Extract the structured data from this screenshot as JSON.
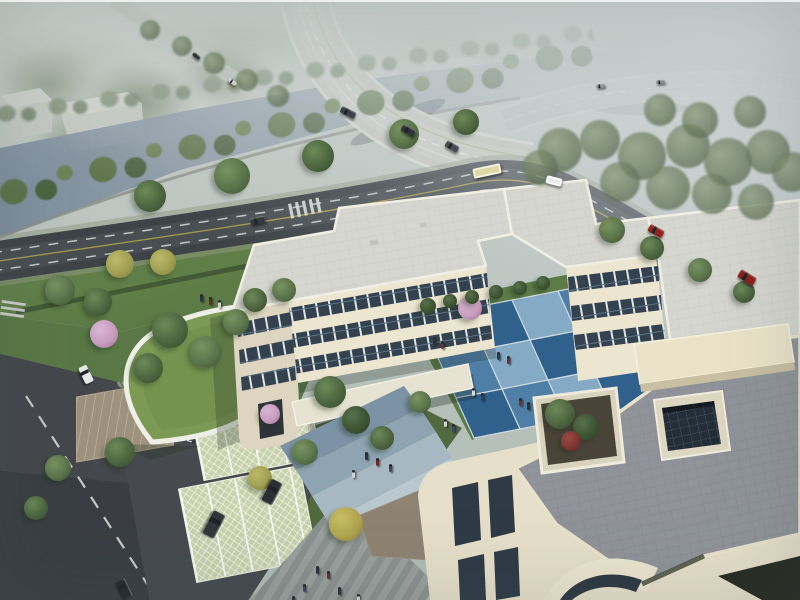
{
  "meta": {
    "title": "Aerial architectural rendering of a courtyard office campus beside a canal and elevated expressway",
    "alt": "Bird's-eye architectural rendering: a cream three-story courtyard building with flat grey roofs and a blue checkerboard courtyard plaza, a leaf-shaped green-roof entrance pavilion, grass-grid parking with dark SUVs, dark asphalt roads with cars and a bus, a blue-grey canal lined with trees, and a curving elevated bridge fading into haze at the top."
  },
  "palette": {
    "sky_haze": "#c5cbc5",
    "water": "#8494a4",
    "asphalt": "#3e4347",
    "bridge_deck": "#c7c7c0",
    "building_wall": "#ece5cf",
    "building_wall_shade": "#ddd5bf",
    "building_roof": "#d6d6d0",
    "terrace_paving": "#90949a",
    "window_dark": "#33424e",
    "lawn": "#5a7845",
    "courtyard_blue_light": "#85aac6",
    "courtyard_blue_mid": "#4f7fa6",
    "courtyard_blue_deep": "#2f618c",
    "blossom_pink": "#c79cbe",
    "parking_grass_grid": "#c8d2ad",
    "lane_dash": "#d9dcd8",
    "lane_yellow": "#b3a44c",
    "tree_colors": {
      "g1": [
        "#6d8a58",
        "#4d6540",
        "#33482c"
      ],
      "g2": [
        "#7a9362",
        "#5a744b",
        "#3d5334"
      ],
      "g3": [
        "#8a9a78",
        "#66785a",
        "#4c5c44"
      ],
      "g3d": [
        "#58704a",
        "#3d5434",
        "#2a3d24"
      ],
      "y1": [
        "#bdb96a",
        "#a19f52",
        "#7d7c3c"
      ],
      "y2": [
        "#cabf66",
        "#b0a650",
        "#8a8038"
      ],
      "p": [
        "#dbb6d4",
        "#c79cbe",
        "#9f729a"
      ],
      "rd": [
        "#9a4a42",
        "#7c3632",
        "#572422"
      ]
    }
  },
  "scene": {
    "objects": [
      "elevated-bridge",
      "canal",
      "main-road",
      "side-street",
      "courtyard-building",
      "blue-checkerboard-courtyard",
      "green-roof-pavilion",
      "roof-terrace",
      "planter",
      "light-well",
      "grass-grid-parking",
      "pedestrian-plaza",
      "entrance-gate"
    ],
    "courtyard": {
      "origin": [
        420,
        318
      ],
      "u": [
        46,
        -9
      ],
      "v": [
        18,
        40
      ],
      "joint": "#cfd9df",
      "colors": {
        "light": "#85aac6",
        "mid": "#4f7fa6",
        "deep": "#2f618c"
      },
      "tiles": [
        [
          "light",
          "deep",
          "light",
          "mid"
        ],
        [
          "mid",
          "light",
          "deep",
          "light"
        ],
        [
          "deep",
          "mid",
          "light",
          "deep"
        ]
      ]
    },
    "trees": [
      [
        60,
        290,
        15,
        "g2"
      ],
      [
        98,
        302,
        14,
        "g1"
      ],
      [
        120,
        264,
        14,
        "y1"
      ],
      [
        163,
        262,
        13,
        "y1"
      ],
      [
        170,
        330,
        18,
        "g1"
      ],
      [
        206,
        352,
        16,
        "g2"
      ],
      [
        148,
        368,
        15,
        "g1"
      ],
      [
        236,
        322,
        13,
        "g2"
      ],
      [
        255,
        300,
        12,
        "g1"
      ],
      [
        284,
        290,
        12,
        "g2"
      ],
      [
        104,
        334,
        14,
        "p"
      ],
      [
        470,
        308,
        12,
        "p"
      ],
      [
        270,
        414,
        10,
        "p"
      ],
      [
        330,
        392,
        16,
        "g1"
      ],
      [
        356,
        420,
        14,
        "g3d"
      ],
      [
        305,
        452,
        13,
        "g2"
      ],
      [
        382,
        438,
        12,
        "g1"
      ],
      [
        420,
        402,
        11,
        "g2"
      ],
      [
        120,
        452,
        15,
        "g1"
      ],
      [
        58,
        468,
        13,
        "g2"
      ],
      [
        36,
        508,
        12,
        "g1"
      ],
      [
        346,
        524,
        17,
        "y2"
      ],
      [
        260,
        478,
        12,
        "y1"
      ],
      [
        612,
        230,
        13,
        "g2"
      ],
      [
        652,
        248,
        12,
        "g1"
      ],
      [
        700,
        270,
        12,
        "g2"
      ],
      [
        744,
        292,
        11,
        "g1"
      ],
      [
        560,
        414,
        15,
        "g1"
      ],
      [
        586,
        427,
        13,
        "g3d"
      ],
      [
        571,
        441,
        10,
        "rd"
      ],
      [
        428,
        306,
        8,
        "g3d"
      ],
      [
        450,
        301,
        7,
        "g3d"
      ],
      [
        472,
        297,
        7,
        "g3d"
      ],
      [
        496,
        292,
        7,
        "g3d"
      ],
      [
        520,
        288,
        7,
        "g3d"
      ],
      [
        543,
        283,
        7,
        "g3d"
      ],
      [
        150,
        196,
        16,
        "g1"
      ],
      [
        232,
        176,
        18,
        "g2"
      ],
      [
        318,
        156,
        16,
        "g1"
      ],
      [
        404,
        134,
        15,
        "g2"
      ],
      [
        466,
        122,
        13,
        "g1"
      ],
      [
        560,
        150,
        22,
        "g3",
        1
      ],
      [
        600,
        140,
        20,
        "g3",
        1
      ],
      [
        642,
        156,
        24,
        "g3",
        1
      ],
      [
        688,
        146,
        22,
        "g3",
        1
      ],
      [
        728,
        162,
        24,
        "g3",
        1
      ],
      [
        768,
        152,
        22,
        "g3",
        1
      ],
      [
        792,
        172,
        20,
        "g3",
        1
      ],
      [
        620,
        182,
        20,
        "g3",
        1
      ],
      [
        668,
        188,
        22,
        "g3",
        1
      ],
      [
        712,
        194,
        20,
        "g3",
        1
      ],
      [
        756,
        202,
        18,
        "g3",
        1
      ],
      [
        540,
        168,
        18,
        "g3",
        1
      ],
      [
        150,
        30,
        10,
        "g3",
        1
      ],
      [
        182,
        46,
        10,
        "g3",
        1
      ],
      [
        214,
        63,
        11,
        "g3",
        1
      ],
      [
        247,
        80,
        11,
        "g3",
        1
      ],
      [
        278,
        96,
        11,
        "g3",
        1
      ],
      [
        700,
        120,
        18,
        "g3",
        1
      ],
      [
        750,
        112,
        16,
        "g3",
        1
      ],
      [
        660,
        110,
        16,
        "g3",
        1
      ]
    ],
    "vehicles": [
      {
        "t": "sedan",
        "x": 348,
        "y": 112,
        "w": 16,
        "h": 7,
        "r": 27,
        "c": "#3a4046"
      },
      {
        "t": "sedan",
        "x": 408,
        "y": 130,
        "w": 15,
        "h": 7,
        "r": 29,
        "c": "#2e3338"
      },
      {
        "t": "sedan",
        "x": 452,
        "y": 146,
        "w": 14,
        "h": 7,
        "r": 30,
        "c": "#454a50"
      },
      {
        "t": "car",
        "x": 600,
        "y": 86,
        "w": 9,
        "h": 4,
        "r": -8,
        "c": "#8a9096"
      },
      {
        "t": "car",
        "x": 660,
        "y": 82,
        "w": 9,
        "h": 4,
        "r": -4,
        "c": "#7f858b"
      },
      {
        "t": "car",
        "x": 196,
        "y": 56,
        "w": 9,
        "h": 4,
        "r": 38,
        "c": "#32363a"
      },
      {
        "t": "car",
        "x": 232,
        "y": 82,
        "w": 9,
        "h": 4,
        "r": 38,
        "c": "#caccc8"
      },
      {
        "t": "bus",
        "x": 487,
        "y": 171,
        "w": 28,
        "h": 10,
        "r": -12,
        "c": "#ded8a4"
      },
      {
        "t": "van",
        "x": 554,
        "y": 181,
        "w": 16,
        "h": 8,
        "r": 14,
        "c": "#e9ebea"
      },
      {
        "t": "car",
        "x": 656,
        "y": 231,
        "w": 16,
        "h": 8,
        "r": 29,
        "c": "#8e2521"
      },
      {
        "t": "suv",
        "x": 747,
        "y": 277,
        "w": 18,
        "h": 9,
        "r": 31,
        "c": "#8c201c"
      },
      {
        "t": "sedan",
        "x": 257,
        "y": 220,
        "w": 15,
        "h": 7,
        "r": -12,
        "c": "#33383c"
      },
      {
        "t": "car",
        "x": 86,
        "y": 374,
        "w": 18,
        "h": 9,
        "r": 64,
        "c": "#e6e8e8"
      },
      {
        "t": "car",
        "x": 124,
        "y": 588,
        "w": 19,
        "h": 9,
        "r": 64,
        "c": "#26292d"
      },
      {
        "t": "suv",
        "x": 214,
        "y": 524,
        "w": 26,
        "h": 13,
        "r": 117,
        "c": "#31363a"
      },
      {
        "t": "suv",
        "x": 272,
        "y": 492,
        "w": 24,
        "h": 12,
        "r": 117,
        "c": "#2b2f33"
      }
    ],
    "people": [
      [
        497,
        352,
        "#323a48"
      ],
      [
        507,
        356,
        "#7a2a28"
      ],
      [
        472,
        388,
        "#d8d8d8"
      ],
      [
        481,
        393,
        "#32405c"
      ],
      [
        519,
        398,
        "#7a2a28"
      ],
      [
        527,
        402,
        "#2c3340"
      ],
      [
        444,
        419,
        "#d0d0d0"
      ],
      [
        452,
        424,
        "#3a4a66"
      ],
      [
        433,
        337,
        "#2c3340"
      ],
      [
        441,
        341,
        "#7a2a28"
      ],
      [
        365,
        452,
        "#2c3340"
      ],
      [
        376,
        458,
        "#6e2826"
      ],
      [
        389,
        464,
        "#36465e"
      ],
      [
        352,
        470,
        "#d4d4d4"
      ],
      [
        316,
        566,
        "#2c3340"
      ],
      [
        327,
        571,
        "#702a28"
      ],
      [
        303,
        584,
        "#36465e"
      ],
      [
        338,
        587,
        "#2c3340"
      ],
      [
        357,
        594,
        "#d0d0d0"
      ],
      [
        292,
        596,
        "#2c3340"
      ],
      [
        200,
        294,
        "#2c3340"
      ],
      [
        209,
        297,
        "#6e2826"
      ],
      [
        218,
        300,
        "#d0d0d0"
      ]
    ]
  }
}
